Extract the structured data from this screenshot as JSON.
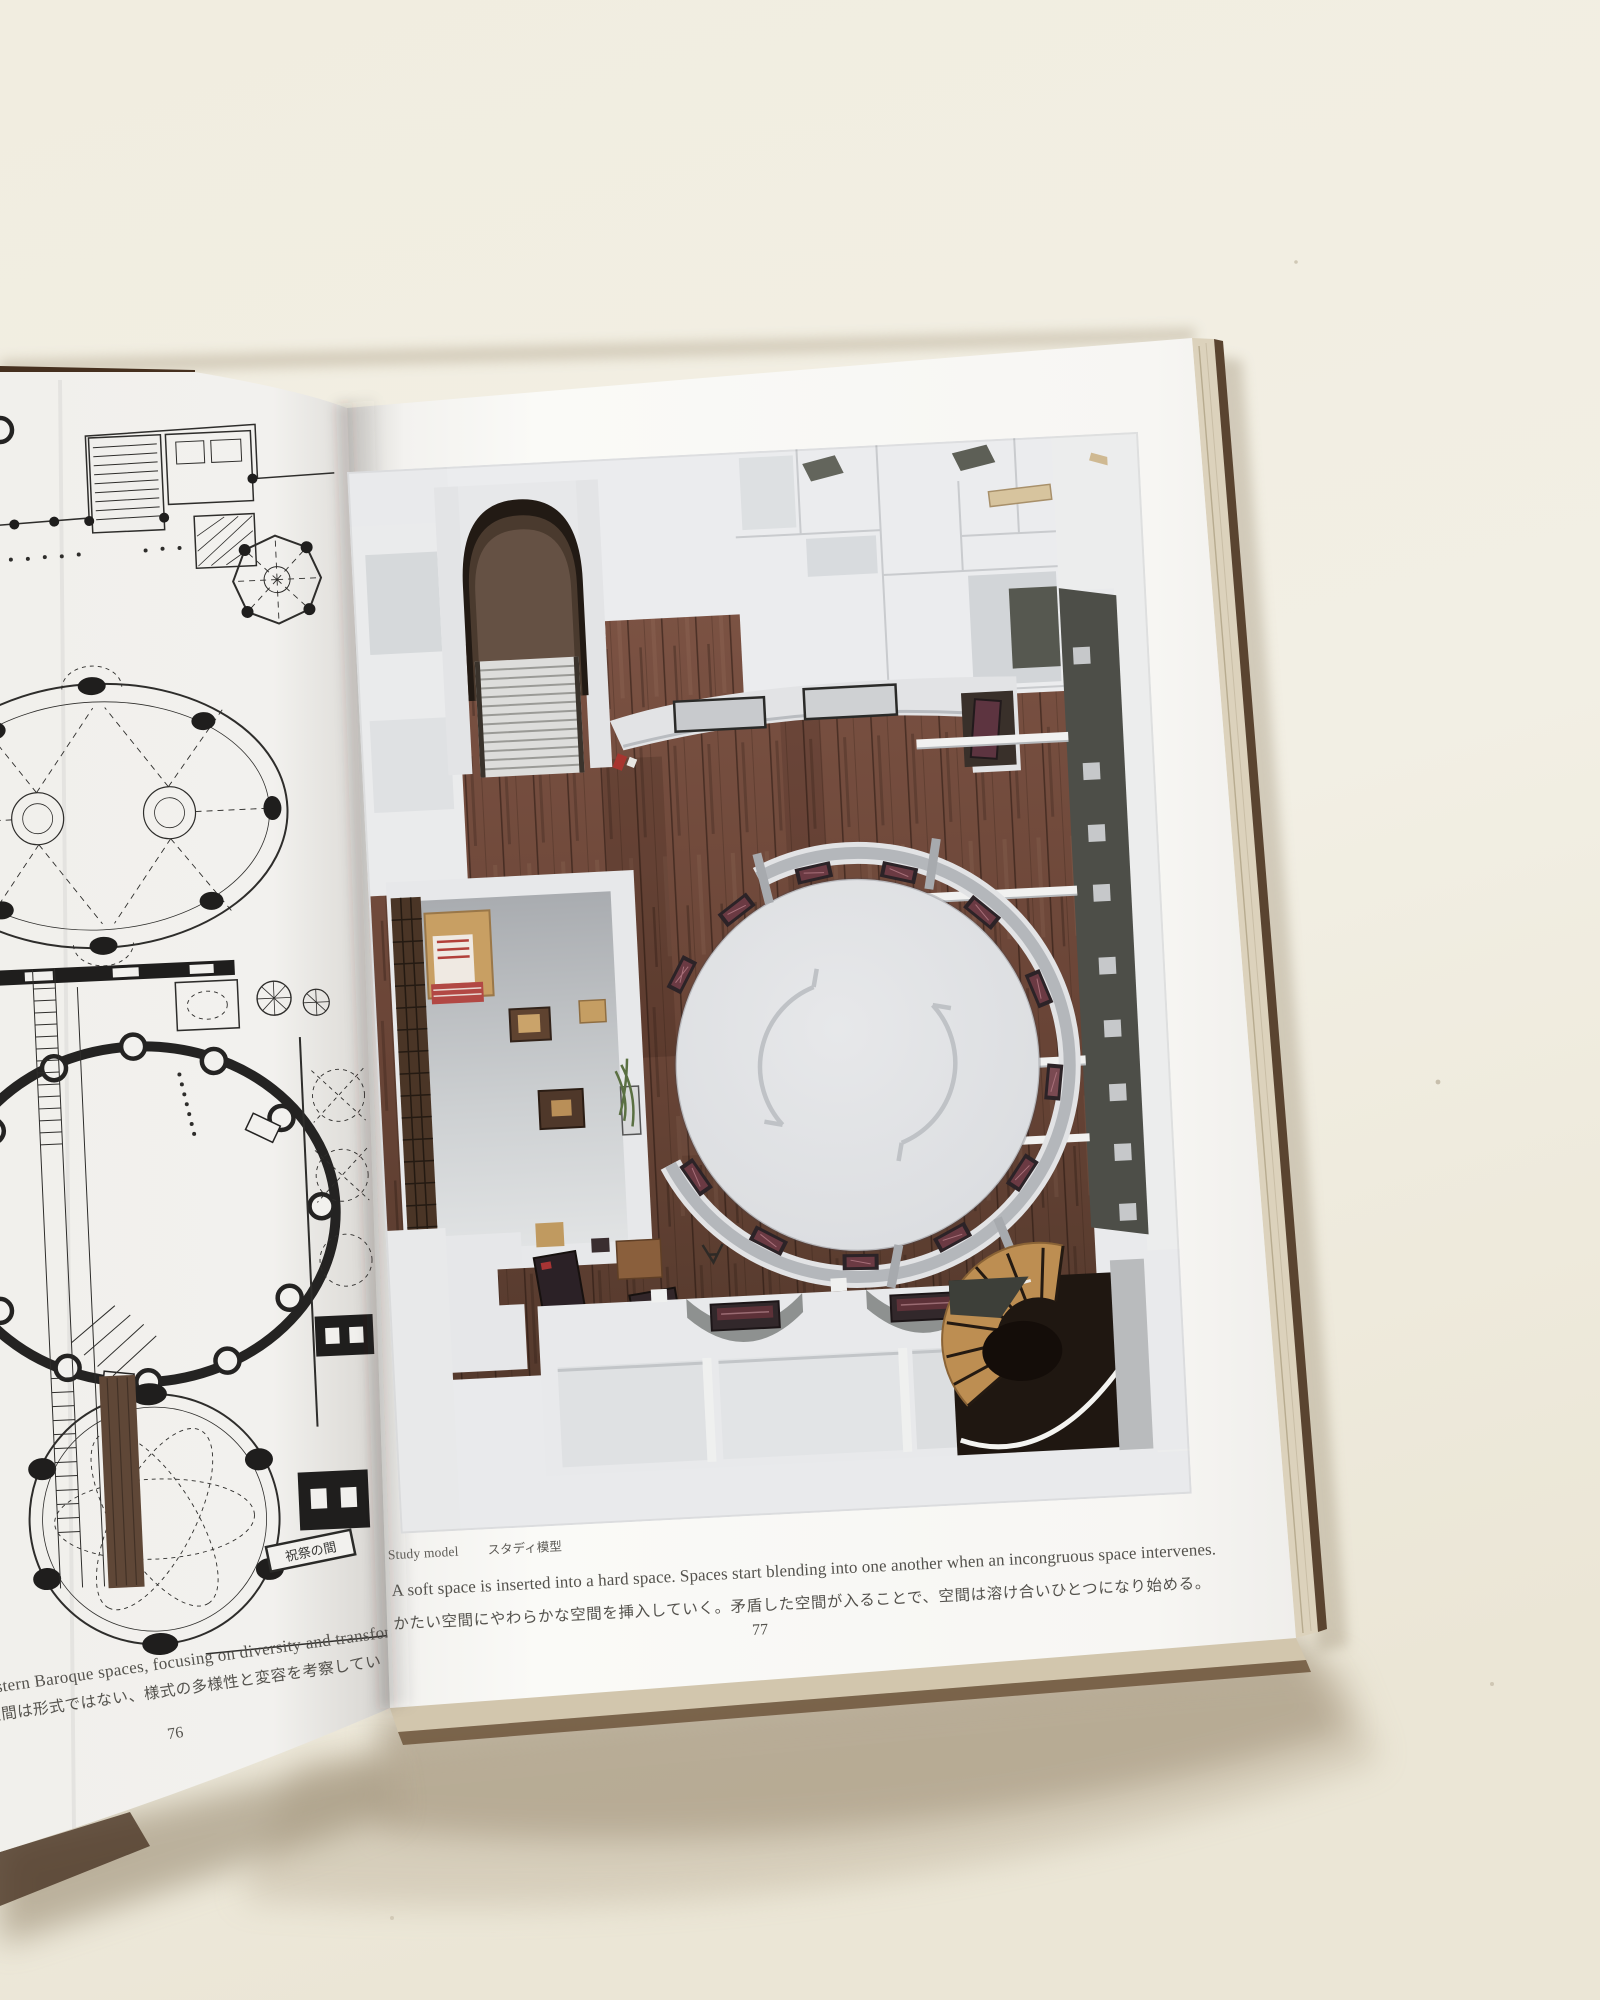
{
  "book": {
    "left_page": {
      "page_number": "76",
      "text_en": "se and Western Baroque spaces, focusing on diversity and transforma",
      "text_jp": "究する。バロックの建築空間は形式ではない、様式の多様性と変容を考察してい",
      "plan_label": "祝祭の間"
    },
    "right_page": {
      "page_number": "77",
      "figure_caption_en": "Study model",
      "figure_caption_jp": "スタディ模型",
      "caption_en": "A soft space is inserted into a hard space. Spaces start blending into one another when an incongruous space intervenes.",
      "caption_jp": "かたい空間にやわらかな空間を挿入していく。矛盾した空間が入ることで、空間は溶け合いひとつになり始める。"
    },
    "colors": {
      "table": "#f0ece0",
      "page": "#f8f7f4",
      "plan_ink": "#2e2d2b",
      "wood_floor": "#6b4437",
      "model_wall": "#e9eaec",
      "bench_upholstery": "#5d3138",
      "corridor_wall": "#4d4e48",
      "cover": "#46301f",
      "caption_text": "#54524d"
    }
  }
}
